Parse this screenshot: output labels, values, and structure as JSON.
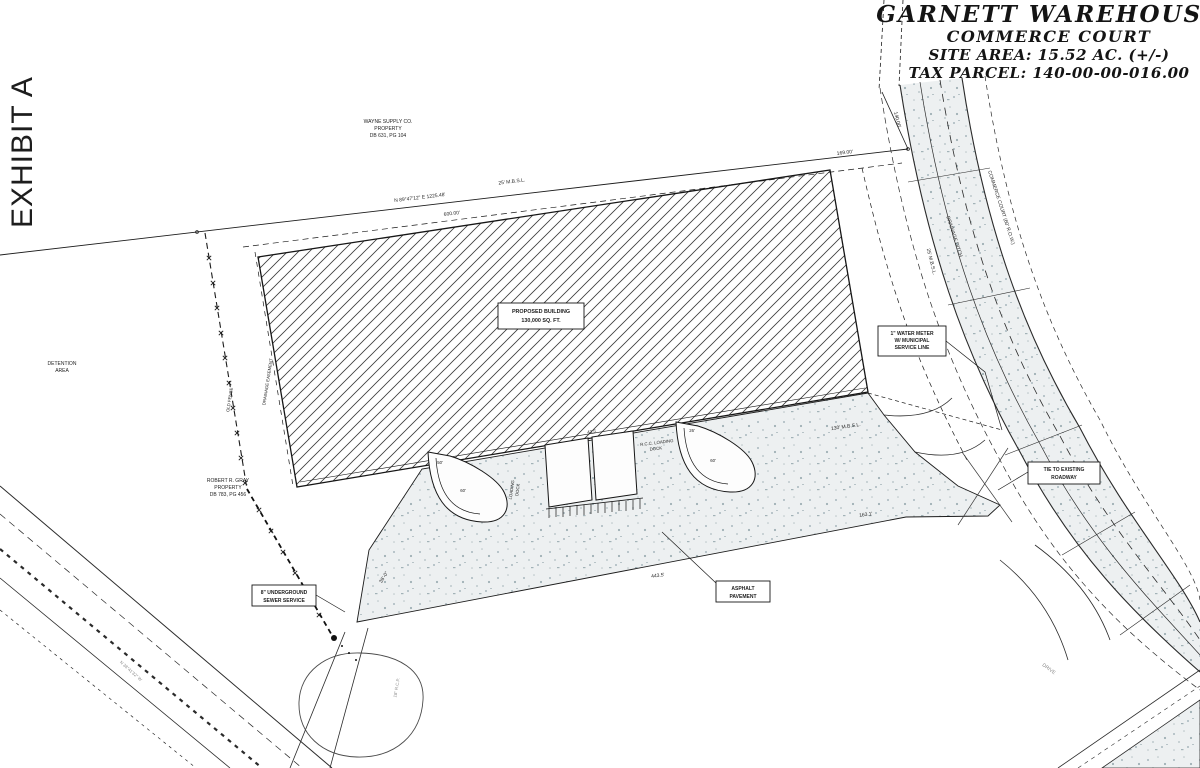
{
  "exhibit": {
    "label": "EXHIBIT A"
  },
  "title_block": {
    "project": "GARNETT WAREHOUSE",
    "subtitle": "COMMERCE COURT",
    "site_area": "SITE AREA: 15.52 AC. (+/-)",
    "tax_parcel": "TAX PARCEL: 140-00-00-016.00"
  },
  "parcels": {
    "wayne_l1": "WAYNE SUPPLY CO.",
    "wayne_l2": "PROPERTY",
    "wayne_l3": "DB 631, PG 104",
    "gray_l1": "ROBERT R. GRAY",
    "gray_l2": "PROPERTY",
    "gray_l3": "DB 783, PG 456",
    "detention_l1": "DETENTION",
    "detention_l2": "AREA"
  },
  "building_label": {
    "l1": "PROPOSED BUILDING",
    "l2": "130,000 SQ. FT."
  },
  "callouts": {
    "water_l1": "1\" WATER METER",
    "water_l2": "W/ MUNICIPAL",
    "water_l3": "SERVICE LINE",
    "tie_l1": "TIE TO EXISTING",
    "tie_l2": "ROADWAY",
    "asphalt_l1": "ASPHALT",
    "asphalt_l2": "PAVEMENT",
    "sewer_l1": "8\" UNDERGROUND",
    "sewer_l2": "SEWER SERVICE"
  },
  "roads": {
    "commerce_court": "COMMERCE COURT (60' R.O.W.)",
    "drainage_ditch": "DRAINAGE DITCH",
    "drive": "DRIVE",
    "fence": "OLD FENCE",
    "easement": "DRAINAGE EASEMENT",
    "bearing_sw": "N 38°41'32\" W",
    "rcp": "18\" R.C.P."
  },
  "dimensions": {
    "bearing_north": "N 89°47'12\" E  1225.48'",
    "mbsl_top": "25' M.B.S.L.",
    "mbsl_right": "25' M.B.S.L.",
    "mbsl_130": "130' M.B.S.L.",
    "len_600": "600.00'",
    "len_169": "169.00'",
    "len_140": "140.00'",
    "len_443": "443.5'",
    "len_163": "163.1'",
    "len_36": "36'-0\"",
    "r50": "50'",
    "r60a": "60'",
    "r60b": "60'",
    "r26": "26'",
    "d435": "43.5'"
  },
  "docks": {
    "loading_l1": "LOADING",
    "loading_l2": "DOCK",
    "rcc_l1": "R.C.C. LOADING",
    "rcc_l2": "DOCK"
  }
}
